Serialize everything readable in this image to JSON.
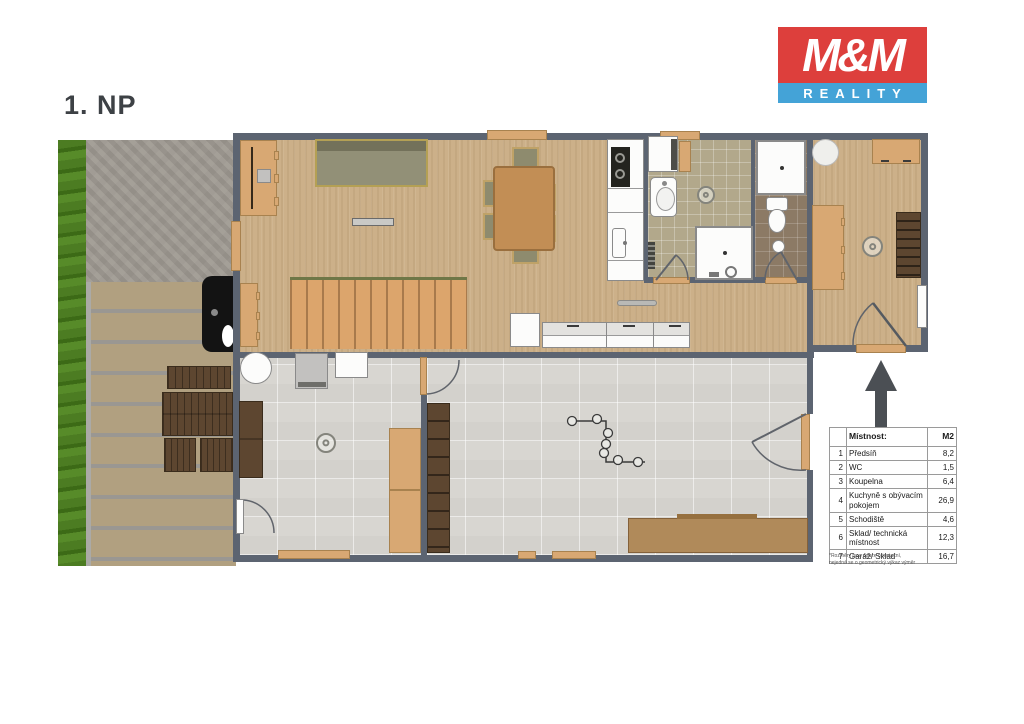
{
  "page": {
    "floor_label": "1. NP"
  },
  "logo": {
    "line1": "M&M",
    "line2": "REALITY",
    "red": "#dd3f3c",
    "blue": "#44a3d7"
  },
  "legend_table": {
    "header": {
      "room": "Místnost:",
      "area": "M2"
    },
    "rows": [
      {
        "num": "1",
        "name": "Předsíň",
        "area": "8,2"
      },
      {
        "num": "2",
        "name": "WC",
        "area": "1,5"
      },
      {
        "num": "3",
        "name": "Koupelna",
        "area": "6,4"
      },
      {
        "num": "4",
        "name": "Kuchyně s obývacím pokojem",
        "area": "26,9"
      },
      {
        "num": "5",
        "name": "Schodiště",
        "area": "4,6"
      },
      {
        "num": "6",
        "name": "Sklad/ technická místnost",
        "area": "12,3"
      },
      {
        "num": "7",
        "name": "Garáž/ Sklad",
        "area": "16,7"
      }
    ],
    "footnote_line1": "*Rozměry jsou pouze orientační,",
    "footnote_line2": "nejedná se o geometrický výkaz výměr"
  },
  "colors": {
    "wall": "#5c6471",
    "wood": "#ccb089",
    "bath_tile": "#b2a88b",
    "wc_tile": "#8c7a65",
    "floor_tile": "#d8d6d1",
    "deck": "#b1a080",
    "hedge": "#4c7c22",
    "accent_door": "#d8a873"
  }
}
